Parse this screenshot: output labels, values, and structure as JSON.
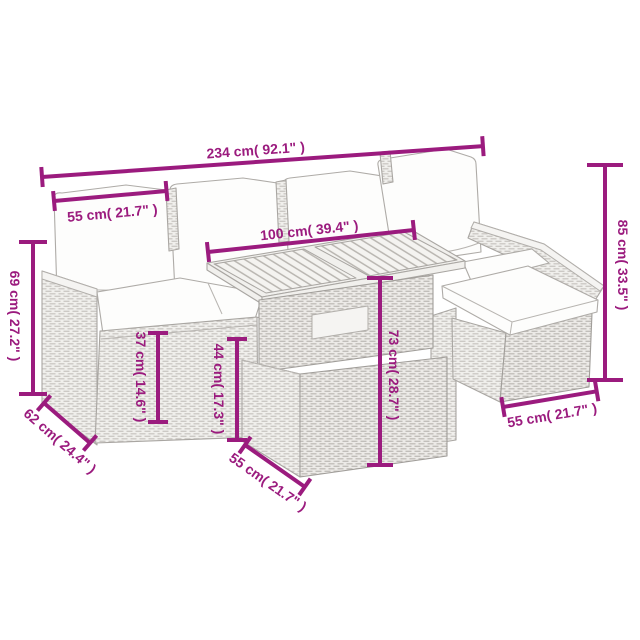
{
  "diagram": {
    "type": "furniture-dimension-diagram",
    "accent_color": "#9B1B7E",
    "line_art_color": "#A9A6A2",
    "background_color": "#FFFFFF",
    "dimensions": [
      {
        "id": "overall-width",
        "label": "234 cm( 92.1\" )",
        "cm": 234,
        "inch": 92.1,
        "orientation": "horizontal-top"
      },
      {
        "id": "seat-width",
        "label": "55 cm( 21.7\" )",
        "cm": 55,
        "inch": 21.7,
        "orientation": "horizontal-upper-left"
      },
      {
        "id": "table-length",
        "label": "100 cm( 39.4\" )",
        "cm": 100,
        "inch": 39.4,
        "orientation": "horizontal-middle"
      },
      {
        "id": "back-height",
        "label": "85 cm( 33.5\" )",
        "cm": 85,
        "inch": 33.5,
        "orientation": "vertical-right"
      },
      {
        "id": "arm-height",
        "label": "69 cm( 27.2\" )",
        "cm": 69,
        "inch": 27.2,
        "orientation": "vertical-left"
      },
      {
        "id": "seat-height",
        "label": "37 cm( 14.6\" )",
        "cm": 37,
        "inch": 14.6,
        "orientation": "vertical-mid-left"
      },
      {
        "id": "base-height",
        "label": "44 cm( 17.3\" )",
        "cm": 44,
        "inch": 17.3,
        "orientation": "vertical-mid"
      },
      {
        "id": "table-height",
        "label": "73 cm( 28.7\" )",
        "cm": 73,
        "inch": 28.7,
        "orientation": "vertical-center"
      },
      {
        "id": "sofa-depth",
        "label": "62 cm( 24.4\" )",
        "cm": 62,
        "inch": 24.4,
        "orientation": "diagonal-bottom-left"
      },
      {
        "id": "table-depth",
        "label": "55 cm( 21.7\" )",
        "cm": 55,
        "inch": 21.7,
        "orientation": "diagonal-bottom-middle"
      },
      {
        "id": "footstool-width",
        "label": "55 cm( 21.7\" )",
        "cm": 55,
        "inch": 21.7,
        "orientation": "horizontal-bottom-right"
      }
    ]
  }
}
